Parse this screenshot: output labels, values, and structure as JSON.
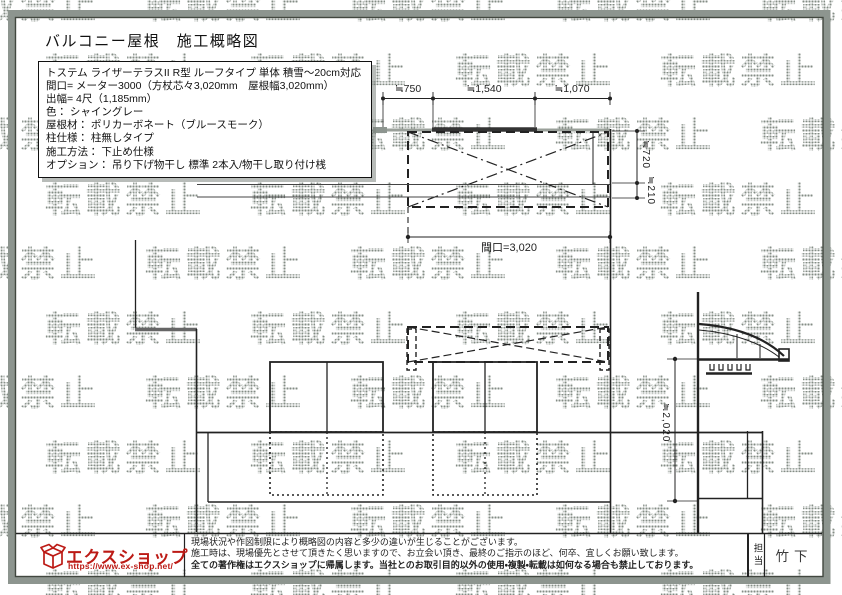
{
  "title": "バルコニー屋根　施工概略図",
  "watermark": {
    "text": "転載禁止"
  },
  "spec_box": {
    "lines": [
      "トステム ライザーテラスII R型 ルーフタイプ 単体 積雪～20cm対応",
      "間口= メーター3000（方杖芯々3,020mm　屋根幅3,020mm）",
      "出幅= 4尺（1,185mm）",
      "色： シャイングレー",
      "屋根材： ポリカーボネート（ブルースモーク）",
      "柱仕様： 柱無しタイプ",
      "施工方法： 下止め仕様",
      "オプション： 吊り下げ物干し 標準 2本入/物干し取り付け桟"
    ]
  },
  "plan_view": {
    "dim_top": [
      "≒750",
      "≒1,540",
      "≒1,070"
    ],
    "dim_right": [
      "≒720",
      "≒210"
    ],
    "dim_bottom": "間口=3,020"
  },
  "side_view": {
    "dim_height": "≒2,020"
  },
  "footer": {
    "logo_text": "エクスショップ",
    "logo_url": "https://www.ex-shop.net/",
    "disclaimer": [
      "現場状況や作図制限により概略図の内容と多少の違いが生じることがございます。",
      "施工時は、現場優先とさせて頂きたく思いますので、お立会い頂き、最終のご指示のほど、何卒、宜しくお願い致します。",
      "全ての著作権はエクスショップに帰属します。当社とのお取引目的以外の使用・複製・転載は如何なる場合も禁止しております。"
    ],
    "staff_label": "担当",
    "staff_name": "竹下"
  },
  "colors": {
    "logo_red": "#bc1a15",
    "border_gray": "#8d958f",
    "line_dark": "#222222",
    "watermark_gray": "#98a09a"
  }
}
